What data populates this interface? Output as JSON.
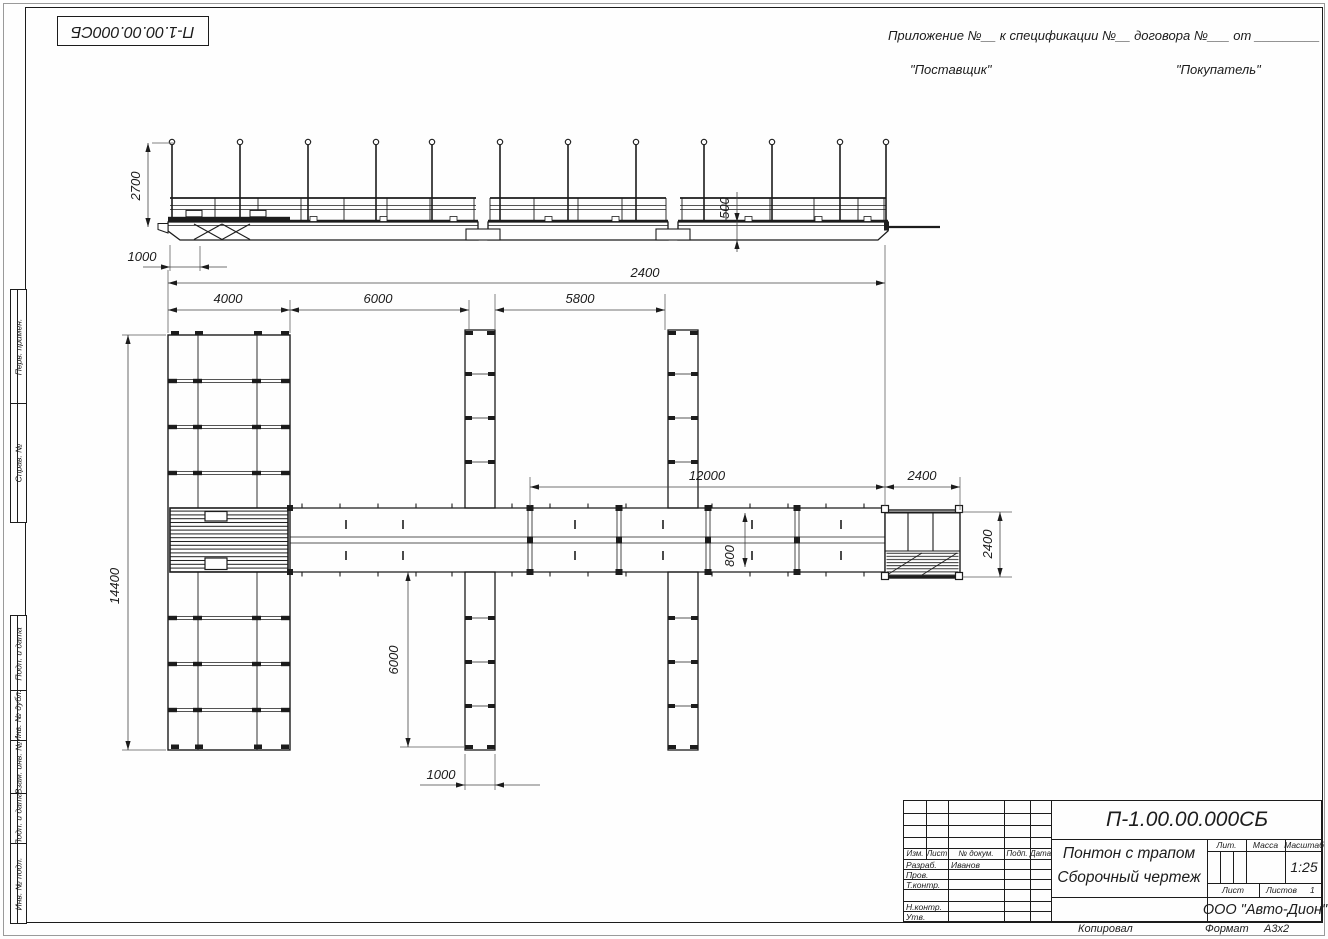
{
  "page": {
    "background": "#fefefe",
    "line_color": "#1c1c1c"
  },
  "corner_stamp": {
    "doc_number": "П-1.00.00.000СБ"
  },
  "header": {
    "appendix_line": "Приложение №__      к спецификации №__    договора №___   от _________",
    "supplier": "\"Поставщик\"",
    "buyer": "\"Покупатель\""
  },
  "margin_labels": {
    "perv_primen": "Перв. примен.",
    "sprav_no": "Справ. №",
    "podp_data_1": "Подп. и дата",
    "inv_dubl": "Инв. № дубл.",
    "vzam_inv": "Взам. инв. №",
    "podp_data_2": "Подп. и дата",
    "inv_podl": "Инв. № подл."
  },
  "dimensions": {
    "elev_height": "2700",
    "elev_left_offset": "1000",
    "hull_depth": "500",
    "total_length": "2400",
    "pier_width": "4000",
    "bay_1": "6000",
    "bay_2": "5800",
    "walkway_length": "12000",
    "shore_span": "2400",
    "walkway_width": "800",
    "platform_width": "2400",
    "pier_length": "14400",
    "finger_length": "6000",
    "finger_width": "1000"
  },
  "title_block": {
    "doc_number": "П-1.00.00.000СБ",
    "title_line1": "Понтон с трапом",
    "title_line2": "Сборочный чертеж",
    "col_izm": "Изм.",
    "col_list": "Лист",
    "col_doc": "№ докум.",
    "col_podp": "Подп.",
    "col_data": "Дата",
    "row_razrab": "Разраб.",
    "razrab_name": "Иванов",
    "row_prov": "Пров.",
    "row_tkontr": "Т.контр.",
    "row_nkontr": "Н.контр.",
    "row_utv": "Утв.",
    "lit_label": "Лит.",
    "massa_label": "Масса",
    "masshtab_label": "Масштаб",
    "scale_value": "1:25",
    "list_label": "Лист",
    "listov_label": "Листов",
    "listov_value": "1",
    "company": "ООО \"Авто-Дион\""
  },
  "footer": {
    "copied": "Копировал",
    "format_label": "Формат",
    "format_value": "А3х2"
  }
}
